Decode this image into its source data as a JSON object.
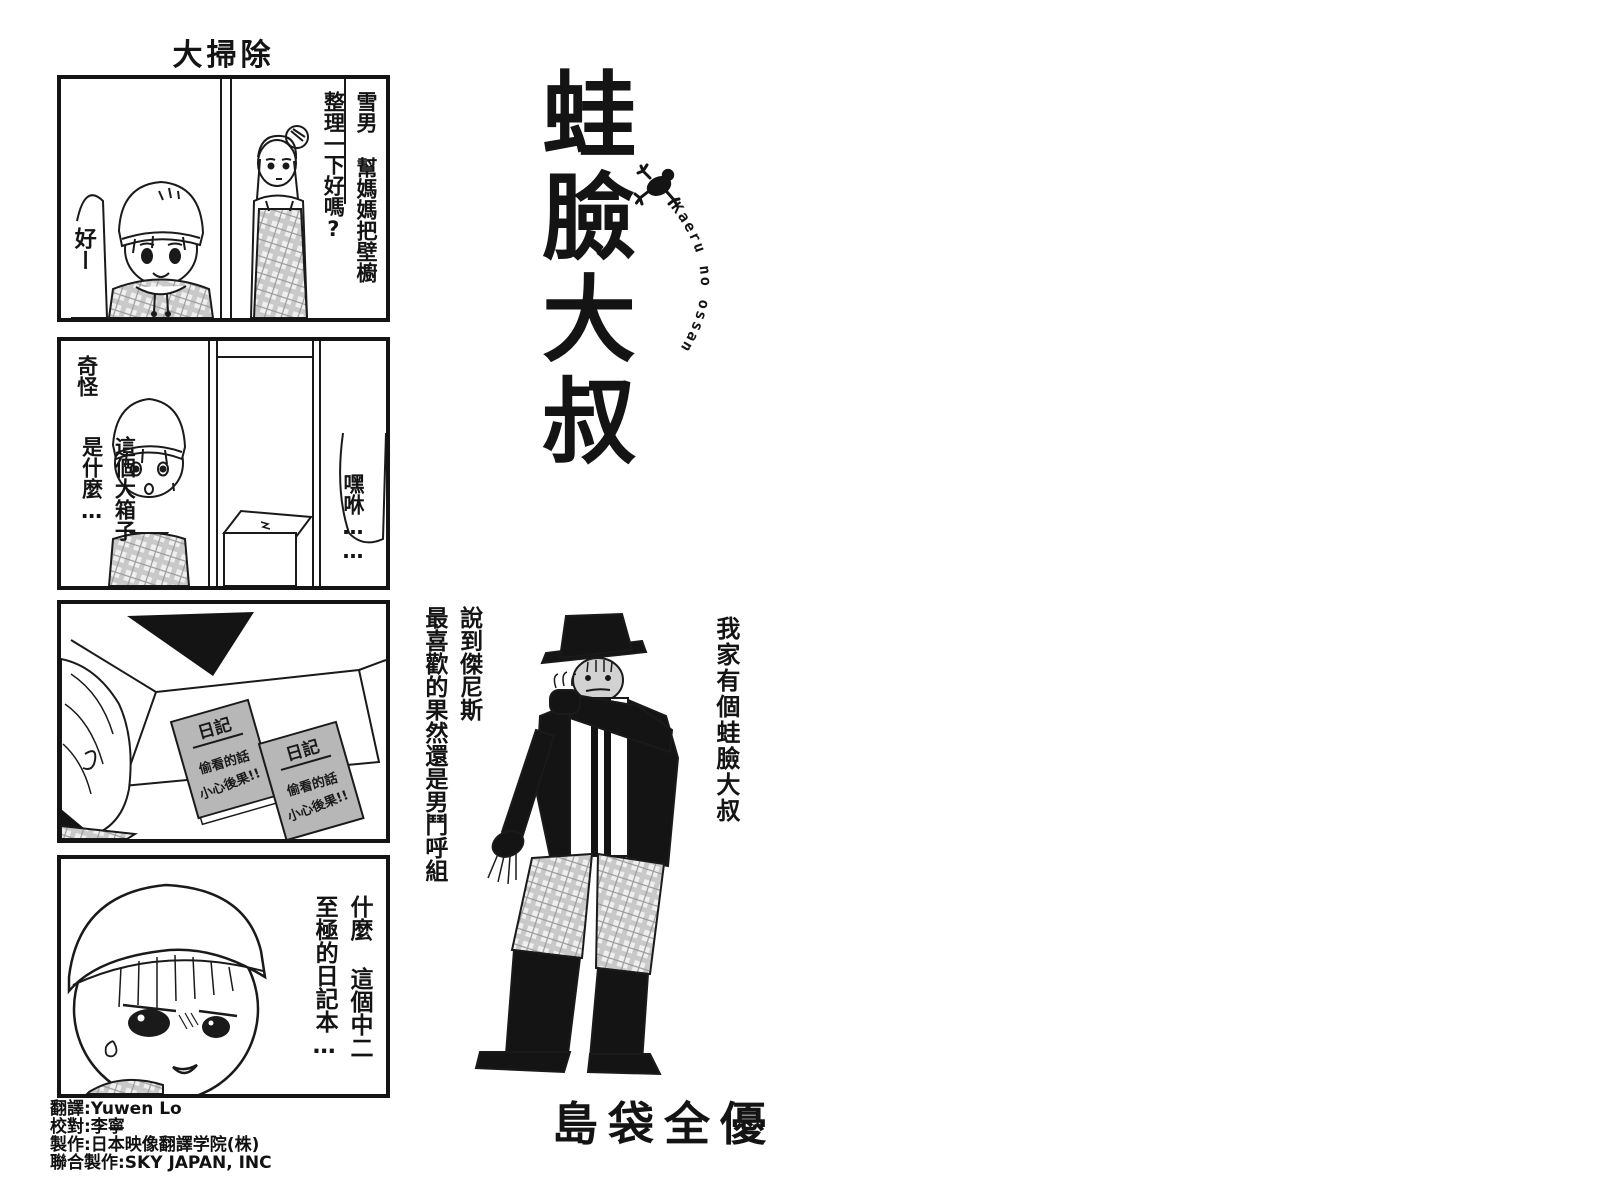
{
  "colors": {
    "ink": "#141414",
    "paper": "#ffffff",
    "halftone_gray": "#b7b7b7",
    "face_gray": "#d2d2d2"
  },
  "strip": {
    "title": "大掃除",
    "panel1": {
      "mother_col1": "雪男 幫媽媽把壁櫥",
      "mother_col2": "整理一下好嗎?",
      "boy_reply": "好ー"
    },
    "panel2": {
      "boy_col1": "奇怪",
      "boy_col2": "這個大箱子",
      "boy_col3": "是什麼…",
      "voice_offscreen": "嘿咻……"
    },
    "panel3": {
      "diary_title": "日記",
      "diary_warn1": "偷看的話",
      "diary_warn2": "小心後果!!"
    },
    "panel4": {
      "boy_col1": "什麼 這個中二",
      "boy_col2": "至極的日記本…"
    }
  },
  "logo": {
    "series_title": "蛙臉大叔",
    "romaji": "Kaeru no ossan",
    "icon": "frog-icon"
  },
  "center": {
    "caption_col1": "說到傑尼斯",
    "caption_col2": "最喜歡的果然還是男鬥呼組",
    "tagline": "我家有個蛙臉大叔",
    "author": "島袋全優"
  },
  "credits": {
    "line1": "翻譯:Yuwen Lo",
    "line2": "校對:李寧",
    "line3": "製作:日本映像翻譯学院(株)",
    "line4": "聯合製作:SKY JAPAN, INC"
  }
}
